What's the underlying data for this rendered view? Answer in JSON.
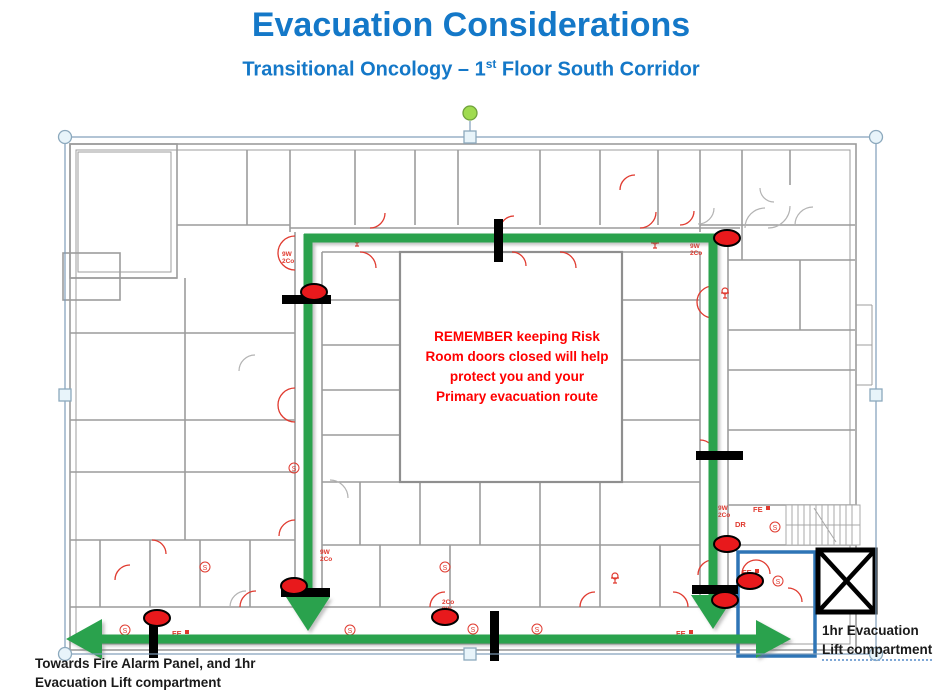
{
  "header": {
    "title": "Evacuation Considerations",
    "subtitle_prefix": "Transitional Oncology – 1",
    "subtitle_sup": "st",
    "subtitle_suffix": " Floor South Corridor"
  },
  "warning": {
    "text": "REMEMBER keeping Risk\nRoom doors closed will help\nprotect you and your\nPrimary evacuation route"
  },
  "labels": {
    "towards_fire_alarm": "Towards Fire Alarm Panel, and 1hr\nEvacuation Lift compartment",
    "lift_line1": "1hr Evacuation",
    "lift_line2": "Lift compartment"
  },
  "plan_labels": {
    "fe": "FE",
    "dr": "DR",
    "w9": "9W",
    "co2": "2Co",
    "s": "S"
  },
  "colors": {
    "title_blue": "#1478C8",
    "warning_red": "#FF0000",
    "route_green": "#2AA24E",
    "marker_red": "#E8191C",
    "door_bar_black": "#000000",
    "lift_outline_blue": "#2E75B6",
    "plan_wall_gray": "#9C9C9C",
    "plan_detail_red": "#E03A2F"
  },
  "annotations": {
    "risk_marker_count": 8,
    "door_bar_count": 7,
    "route_arrowhead_count": 4
  }
}
